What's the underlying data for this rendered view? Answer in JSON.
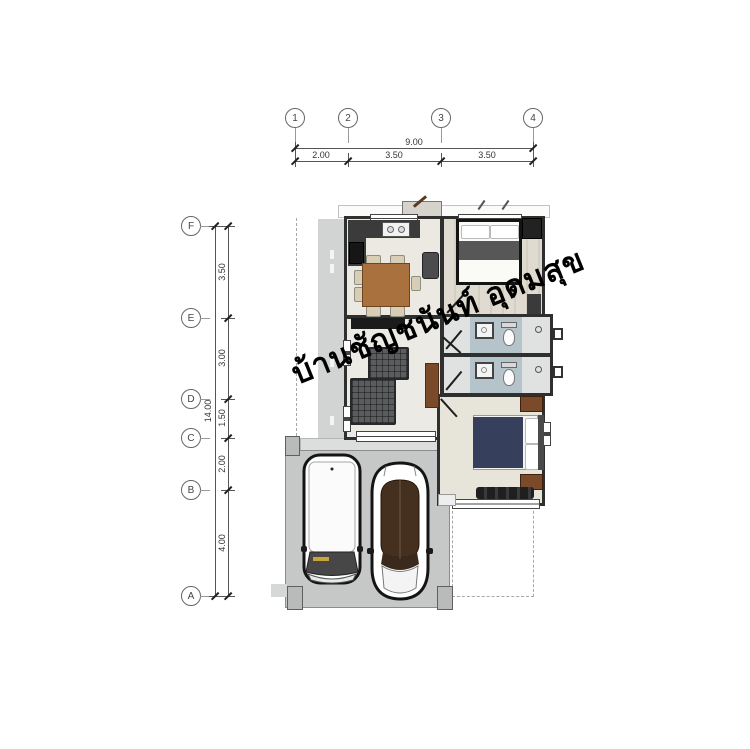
{
  "watermark": "บ้านชัญชนันท์ อุดมสุข",
  "grid": {
    "column_labels": [
      "1",
      "2",
      "3",
      "4"
    ],
    "row_labels": [
      "F",
      "E",
      "D",
      "C",
      "B",
      "A"
    ]
  },
  "dimensions": {
    "top": {
      "total": "9.00",
      "segments": [
        "2.00",
        "3.50",
        "3.50"
      ]
    },
    "left": {
      "total": "14.00",
      "segments": [
        "3.50",
        "3.00",
        "1.50",
        "2.00",
        "4.00"
      ]
    }
  },
  "palette": {
    "wall": "#2f2f2f",
    "carport_concrete": "#c6c8c8",
    "walkway": "#d2d4d4",
    "bathroom_tile": "#b5c3ca",
    "wood_table": "#a8713d",
    "cabinet_brown": "#7b4a2a",
    "bed_blanket_navy": "#36405d",
    "bed_blanket_gray": "#575757",
    "sofa_gray": "#5a5c5e",
    "car_glass_brown": "#45301f"
  }
}
